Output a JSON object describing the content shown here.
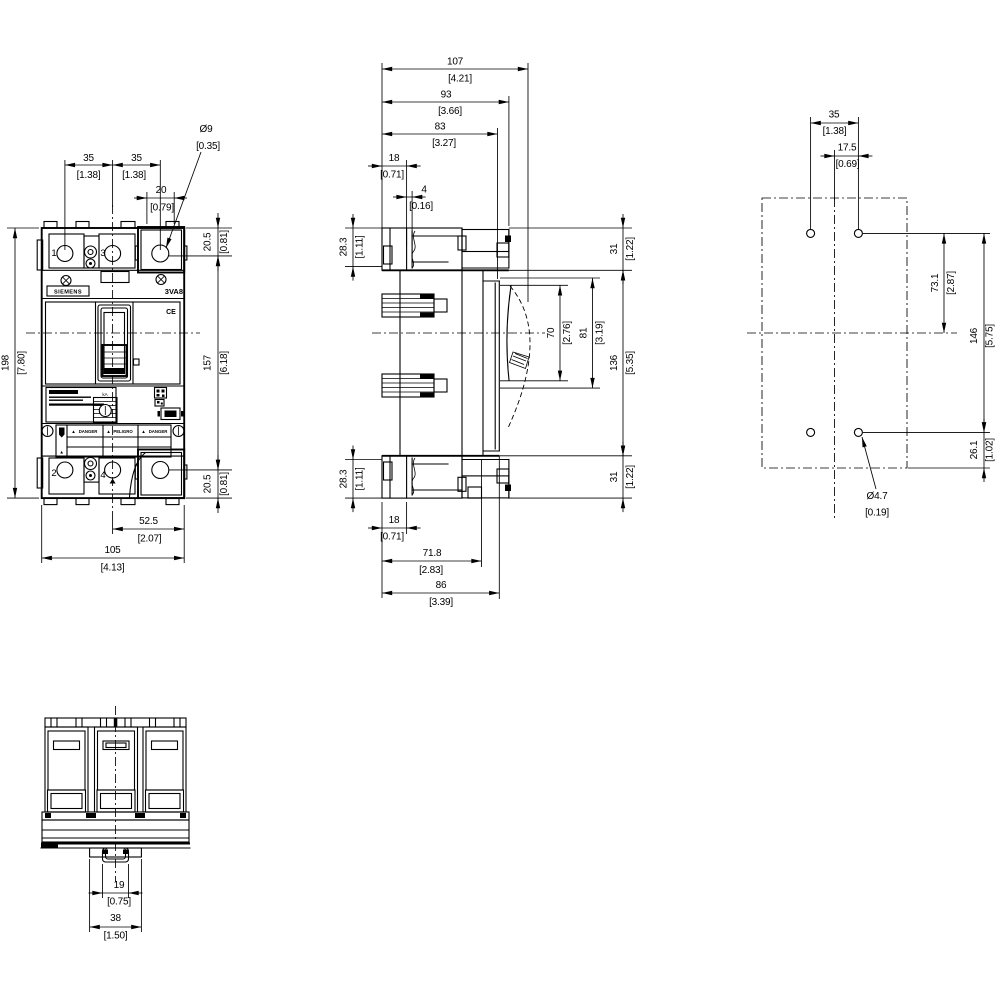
{
  "drawing": {
    "front": {
      "brand": "SIEMENS",
      "model": "3VA8",
      "ce_mark": "CE",
      "dial_label": "kA",
      "terminals": {
        "t1": "1",
        "t3": "3",
        "t2": "2",
        "t4": "4"
      },
      "warning": {
        "icon": "▲",
        "labels": [
          "DANGER",
          "PELIGRO",
          "DANGER"
        ]
      },
      "dims": {
        "pole_pitch_left": {
          "mm": "35",
          "in": "[1.38]"
        },
        "pole_pitch_right": {
          "mm": "35",
          "in": "[1.38]"
        },
        "terminal_width": {
          "mm": "20",
          "in": "[0.79]"
        },
        "terminal_hole_dia": {
          "mm": "Ø9",
          "in": "[0.35]"
        },
        "top_hole_offset": {
          "mm": "20.5",
          "in": "[0.81]"
        },
        "overall_height": {
          "mm": "198",
          "in": "[7.80]"
        },
        "hole_spacing_v": {
          "mm": "157",
          "in": "[6.18]"
        },
        "bottom_hole_offset": {
          "mm": "20.5",
          "in": "[0.81]"
        },
        "center_to_edge": {
          "mm": "52.5",
          "in": "[2.07]"
        },
        "overall_width": {
          "mm": "105",
          "in": "[4.13]"
        }
      }
    },
    "side": {
      "dims": {
        "overall_depth": {
          "mm": "107",
          "in": "[4.21]"
        },
        "depth_93": {
          "mm": "93",
          "in": "[3.66]"
        },
        "depth_83": {
          "mm": "83",
          "in": "[3.27]"
        },
        "top_18": {
          "mm": "18",
          "in": "[0.71]"
        },
        "lip_4": {
          "mm": "4",
          "in": "[0.16]"
        },
        "top_terminal_h": {
          "mm": "28.3",
          "in": "[1.11]"
        },
        "top_31": {
          "mm": "31",
          "in": "[1.22]"
        },
        "handle_70": {
          "mm": "70",
          "in": "[2.76]"
        },
        "handle_81": {
          "mm": "81",
          "in": "[3.19]"
        },
        "body_136": {
          "mm": "136",
          "in": "[5.35]"
        },
        "bottom_terminal_h": {
          "mm": "28.3",
          "in": "[1.11]"
        },
        "bottom_31": {
          "mm": "31",
          "in": "[1.22]"
        },
        "bottom_18": {
          "mm": "18",
          "in": "[0.71]"
        },
        "bottom_71_8": {
          "mm": "71.8",
          "in": "[2.83]"
        },
        "bottom_86": {
          "mm": "86",
          "in": "[3.39]"
        }
      }
    },
    "drill": {
      "dims": {
        "hole_pitch_35": {
          "mm": "35",
          "in": "[1.38]"
        },
        "center_off_17_5": {
          "mm": "17.5",
          "in": "[0.69]"
        },
        "top_to_center": {
          "mm": "73.1",
          "in": "[2.87]"
        },
        "hole_spacing_146": {
          "mm": "146",
          "in": "[5.75]"
        },
        "bottom_off_26_1": {
          "mm": "26.1",
          "in": "[1.02]"
        },
        "hole_dia": {
          "mm": "Ø4.7",
          "in": "[0.19]"
        }
      }
    },
    "bottom": {
      "dims": {
        "rail_slot_19": {
          "mm": "19",
          "in": "[0.75]"
        },
        "foot_width_38": {
          "mm": "38",
          "in": "[1.50]"
        }
      }
    }
  }
}
